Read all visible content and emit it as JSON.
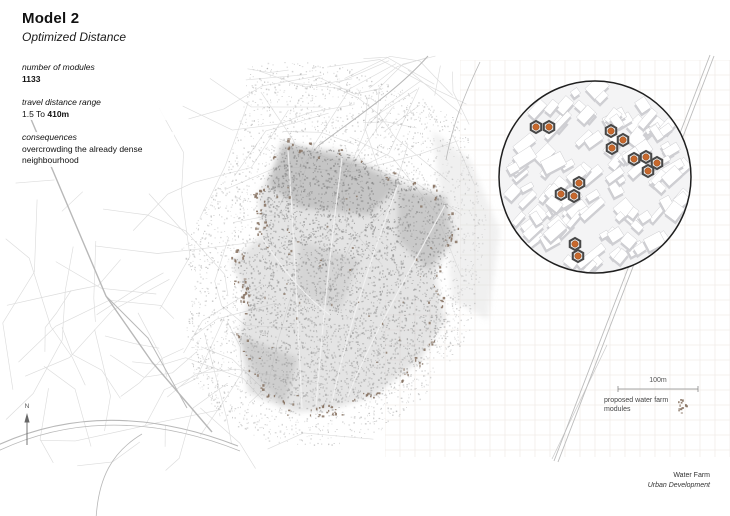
{
  "header": {
    "title": "Model 2",
    "subtitle": "Optimized Distance"
  },
  "stats": {
    "modules_label": "number of modules",
    "modules_value": "1133",
    "distance_label": "travel distance range",
    "distance_prefix": "1.5 To ",
    "distance_value": "410m",
    "consequences_label": "consequences",
    "consequences_text": "overcrowding the already dense neighbourhood"
  },
  "map": {
    "compass_label": "N",
    "scale_label": "100m",
    "legend_label": "proposed water farm modules"
  },
  "inset": {
    "center_x": 595,
    "center_y": 177,
    "radius": 96,
    "module_count": 14,
    "module_positions": [
      [
        536,
        127
      ],
      [
        549,
        127
      ],
      [
        611,
        131
      ],
      [
        623,
        140
      ],
      [
        612,
        148
      ],
      [
        634,
        159
      ],
      [
        646,
        157
      ],
      [
        657,
        163
      ],
      [
        648,
        171
      ],
      [
        579,
        183
      ],
      [
        561,
        194
      ],
      [
        574,
        196
      ],
      [
        575,
        244
      ],
      [
        578,
        256
      ]
    ]
  },
  "footer": {
    "project": "Water Farm",
    "series": "Urban Development"
  },
  "colors": {
    "module_orange": "#c8682c",
    "module_ring": "#474747",
    "proposed_dot_brown": "#85705f",
    "grid_line": "#f1ece9",
    "street_gray": "#dcdcdc",
    "road_gray": "#b8b8b8",
    "ink": "#111111"
  }
}
